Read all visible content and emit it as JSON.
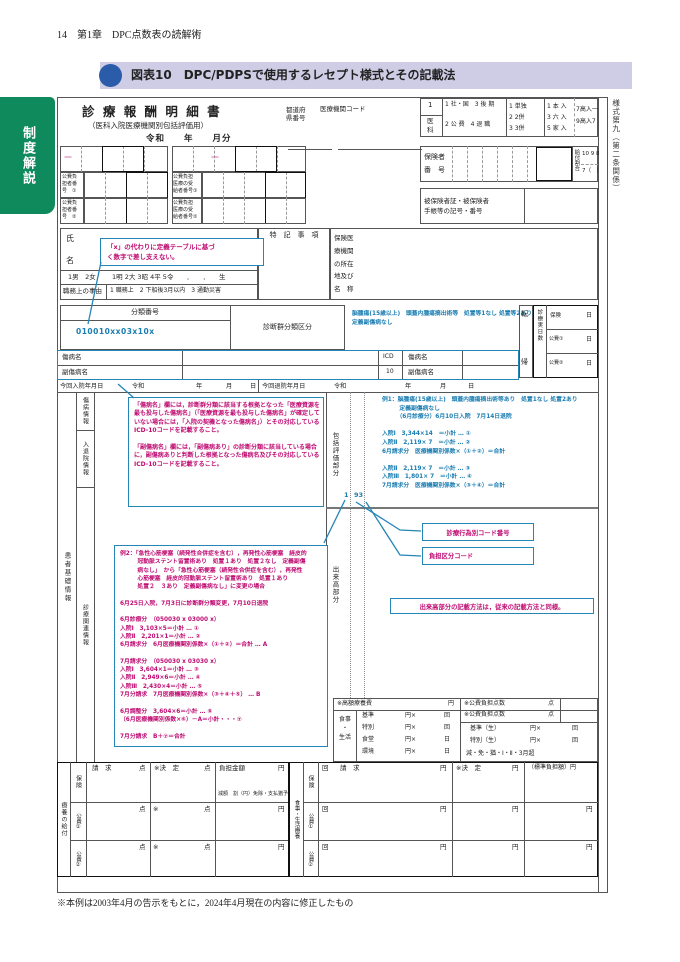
{
  "page": {
    "header": "14　第1章　DPC点数表の読解術",
    "figure_title": "図表10　DPC/PDPSで使用するレセプト様式とその記載法",
    "tab": "制度解説",
    "style_no": "様式第九（第二条関係）",
    "footnote": "※本例は2003年4月の告示をもとに，2024年4月現在の内容に修正したもの"
  },
  "formHead": {
    "title": "診 療 報 酬 明 細 書",
    "subtitle": "（医科入院医療機関別包括評価用）",
    "era": "令和　　年　　月分",
    "pref": "都道府\n県番号",
    "code": "医療機関コード",
    "k_ika_no": "1",
    "k_ika": "医\n科",
    "k_r1": "1 社・国　3 後 期",
    "k_r2": "2 公 費　4 退 職",
    "k_tan": "1 単独\n2 2併\n3 3併",
    "k_nyu": "1 本 入\n3 六 入\n5 家 入",
    "k_ko": "7高入一\n9高入7",
    "insurer": "保険者\n番　号",
    "ratio": "給付割合",
    "ratio1": "10 9 8",
    "ratio2": "7（　）",
    "card": "被保険者証・被保険者\n手帳等の記号・番号"
  },
  "kohi": {
    "p1": "公費負\n担者番\n号　①",
    "r1": "公費負担\n医療の受\n給者番号①",
    "p2": "公費負\n担者番\n号　②",
    "r2": "公費負担\n医療の受\n給者番号②",
    "dash": "—"
  },
  "name": {
    "a": "氏",
    "b": "名",
    "sex": "1男　2女",
    "birth": "1明 2大 3昭 4平 5令　　．　　．　　生",
    "duty": "職務上の事由",
    "opts": "1 職務上　2 下船後3月以内　3 通勤災害",
    "tokki": "特　記　事　項",
    "hosp": "保険医\n療機関\nの所在\n地及び\n名　称"
  },
  "cls": {
    "label": "分類番号",
    "value": "010010xx03x10x",
    "dpc": "診断群分類区分",
    "dpcv": "脳腫瘍(15歳以上)　頭蓋内腫瘍摘出術等　処置等1なし 処置等2あり\n定義副傷病なし",
    "ten": "転",
    "ki": "帰",
    "days": "診療実日数",
    "hoken": "保険",
    "kohi1": "公費①",
    "kohi2": "公費②",
    "day": "日",
    "sick": "傷病名",
    "subsick": "副傷病名",
    "icd": "ICD",
    "icd10": "10",
    "adm": "今回入院年月日",
    "dis": "今回退院年月日",
    "era": "令和",
    "y": "年",
    "m": "月",
    "d": "日"
  },
  "sec": {
    "base": "患者基礎情報",
    "sick": "傷病情報",
    "inout": "入退院情報",
    "care": "診療関連情報",
    "hokatsu": "包括評価部分",
    "dekidaka": "出来高部分",
    "n1": "1",
    "n93": "93"
  },
  "notes": {
    "x": "「x」の代わりに定義テーブルに基づ\nく数字で差し支えない。",
    "disease": "「傷病名」欄には，診断群分類に該当する根拠となった「医療資源を最も投与した傷病名」（「医療資源を最も投与した傷病名」が確定していない場合には，「入院の契機となった傷病名」）とその対応しているICD-10コードを記載すること。\n\n「副傷病名」欄には，「副傷病あり」の診断分類に該当している場合に，副傷病ありと判断した根拠となった傷病名及びその対応しているICD-10コードを記載すること。",
    "ex1": "例1：脳腫瘍(15歳以上)　頭蓋内腫瘍摘出術等あり　処置1なし 処置2あり\n　　　定義副傷病なし\n　　　（6月診療分）6月10日入院　7月14日退院\n\n入院Ⅰ　3,344×14　＝小計 … ①\n入院Ⅱ　2,119× 7　＝小計 … ②\n6月請求分　医療機関別係数×（①＋②）＝合計\n\n入院Ⅱ　2,119× 7　＝小計 … ③\n入院Ⅲ　1,801× 7　＝小計 … ④\n7月請求分　医療機関別係数×（③＋④）＝合計",
    "ex2": "例2：「急性心筋梗塞（続発性合併症を含む），再発性心筋梗塞　経皮的\n　　　冠動脈ステント留置術あり　処置１あり　処置２なし　定義副傷\n　　　病なし」　から「急性心筋梗塞（続発性合併症を含む），再発性\n　　　心筋梗塞　経皮的冠動脈ステント留置術あり　処置１あり\n　　　処置２　３あり　定義副傷病なし」に変更の場合\n\n6月25日入院，7月3日に診断群分類変更，7月10日退院\n\n6月診療分　（050030 x 03000 x）\n入院Ⅰ　3,103×5＝小計 … ①\n入院Ⅱ　2,201×1＝小計 … ②\n6月請求分　6月医療機関別係数×（①＋②）＝合計 … A\n\n7月請求分　（050030 x 03030 x）\n入院Ⅰ　3,604×1＝小計 … ③\n入院Ⅱ　2,949×6＝小計 … ④\n入院Ⅲ　2,430×4＝小計 … ⑤\n7月分請求　7月医療機関別係数×（③＋④＋⑤） … B\n\n6月調整分　3,604×6＝小計 … ⑥\n（6月医療機関別係数×⑥）－A＝小計・・・⑦\n\n7月分請求　B＋⑦＝合計",
    "code": "診療行為別コード番号",
    "burden": "負担区分コード",
    "dekidaka": "出来高部分の記載方法は，従来の記載方法と同様。"
  },
  "meal": {
    "kogaku": "※高額療養費",
    "yen": "円",
    "label": "食事\n・\n生活",
    "b1": "基準",
    "b2": "特別",
    "b3": "食堂",
    "b4": "環境",
    "yx": "円×",
    "kai": "回",
    "hi": "日",
    "kp": "※公費負担点数",
    "pt": "点",
    "ks": "基準（生）",
    "ts": "特別（生）",
    "gen": "減・免・猶・Ⅰ・Ⅱ・3月超"
  },
  "bottom": {
    "ryoyo": "療養の給付",
    "hoken": "保険",
    "kohi1": "公費①",
    "kohi2": "公費②",
    "req": "請　求",
    "ten": "点",
    "kettei": "※決　定",
    "futan": "負担金額",
    "yen": "円",
    "gengaku": "減額　割（円）免除・支払猶予",
    "ast": "※",
    "shokuji": "食事・生活療養",
    "kai": "回",
    "std": "（標準負担額）円"
  }
}
